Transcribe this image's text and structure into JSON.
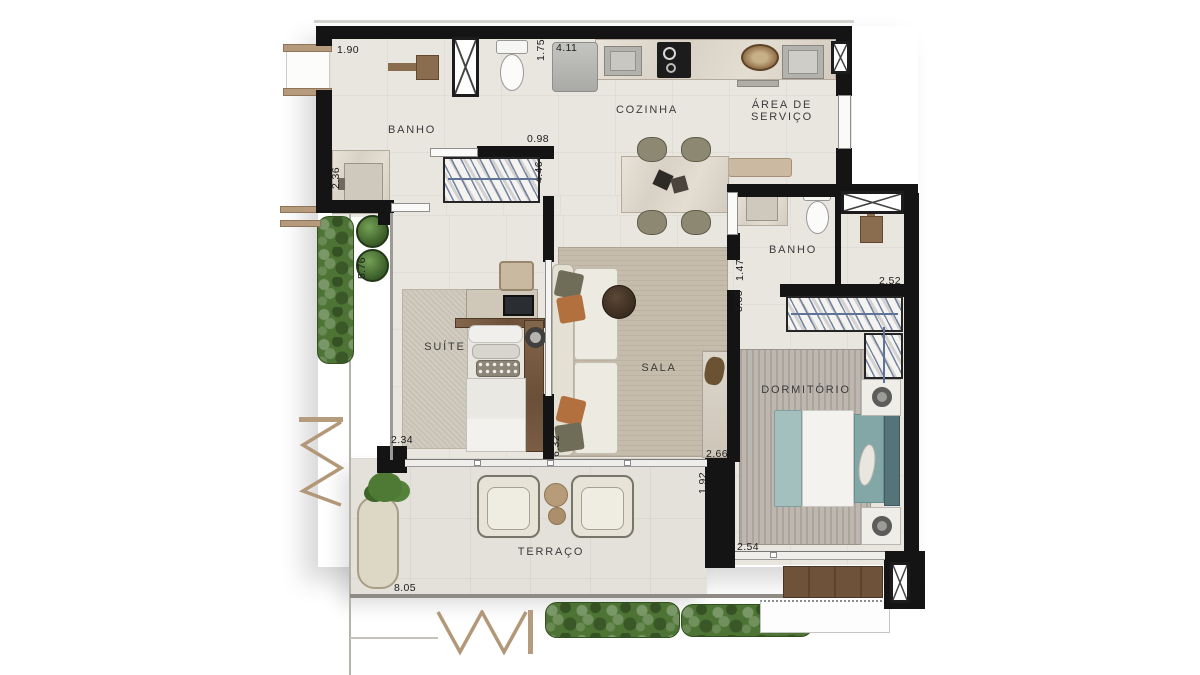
{
  "rooms": {
    "banho1": "BANHO",
    "cozinha": "COZINHA",
    "area_servico_1": "ÁREA DE",
    "area_servico_2": "SERVIÇO",
    "banho2": "BANHO",
    "suite": "SUÍTE",
    "sala": "SALA",
    "dormitorio": "DORMITÓRIO",
    "terraco": "TERRAÇO"
  },
  "dims": {
    "d190": "1.90",
    "d175": "1.75",
    "d411": "4.11",
    "d098": "0.98",
    "d446": "4.46",
    "d236": "2.36",
    "d576": "5.76",
    "d234": "2.34",
    "d632": "6.32",
    "d266": "2.66",
    "d192": "1.92",
    "d805": "8.05",
    "d254": "2.54",
    "d252": "2.52",
    "d147": "1.47",
    "d385": "3.85"
  },
  "colors": {
    "wall": "#141414",
    "floor": "#e9e6e0",
    "terrace_floor": "#e4e1da",
    "wood": "#7b5f46",
    "hedge_green": "#4d7434",
    "bed_teal": "#9dbcbb"
  }
}
